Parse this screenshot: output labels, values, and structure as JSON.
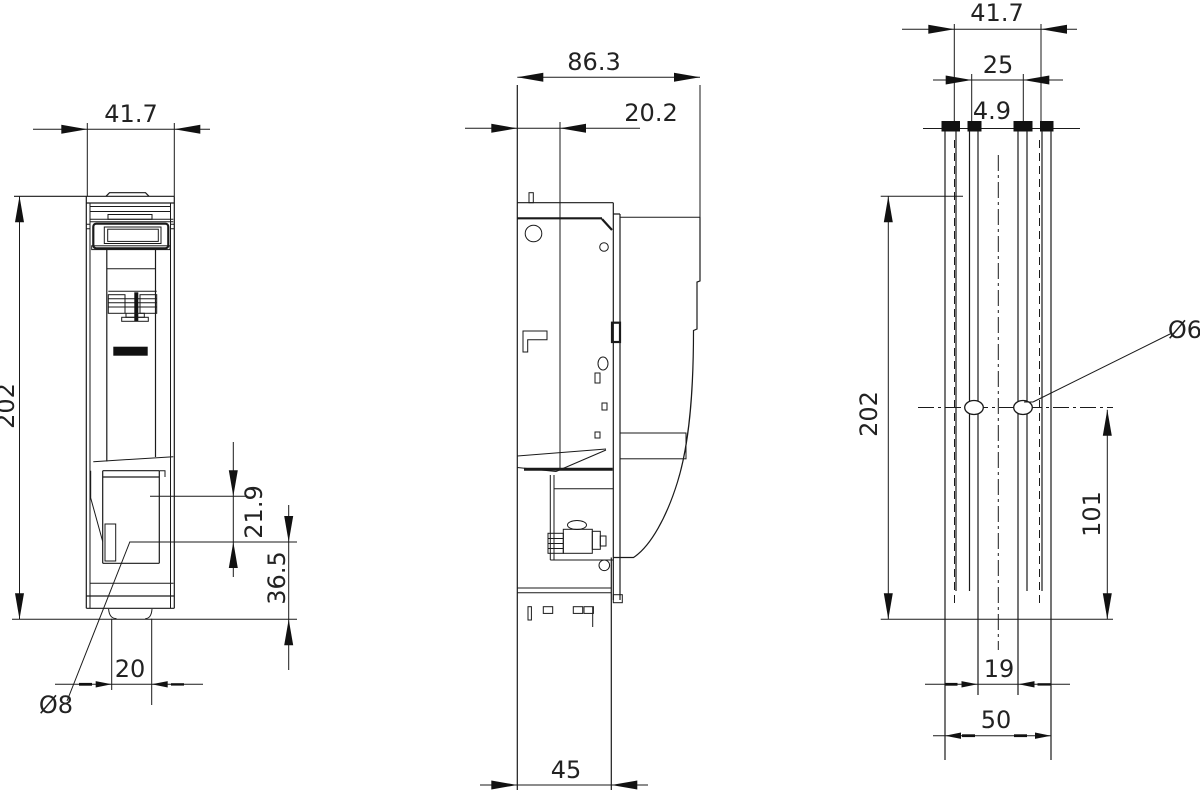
{
  "drawing": {
    "kind": "dimension-drawing",
    "views": {
      "front": {
        "dims": {
          "width": "41.7",
          "height": "202",
          "cutout_top": "21.9",
          "base_height": "36.5",
          "foot_width": "20",
          "hole_dia": "Ø8"
        }
      },
      "side": {
        "dims": {
          "depth": "86.3",
          "rail_offset": "20.2",
          "base_depth": "45"
        }
      },
      "rear": {
        "dims": {
          "width": "41.7",
          "rail_spacing": "25",
          "slot_width": "4.9",
          "height": "202",
          "hole_dia": "Ø6",
          "hole_offset": "101",
          "hole_spacing": "19",
          "base_width": "50"
        }
      }
    }
  }
}
